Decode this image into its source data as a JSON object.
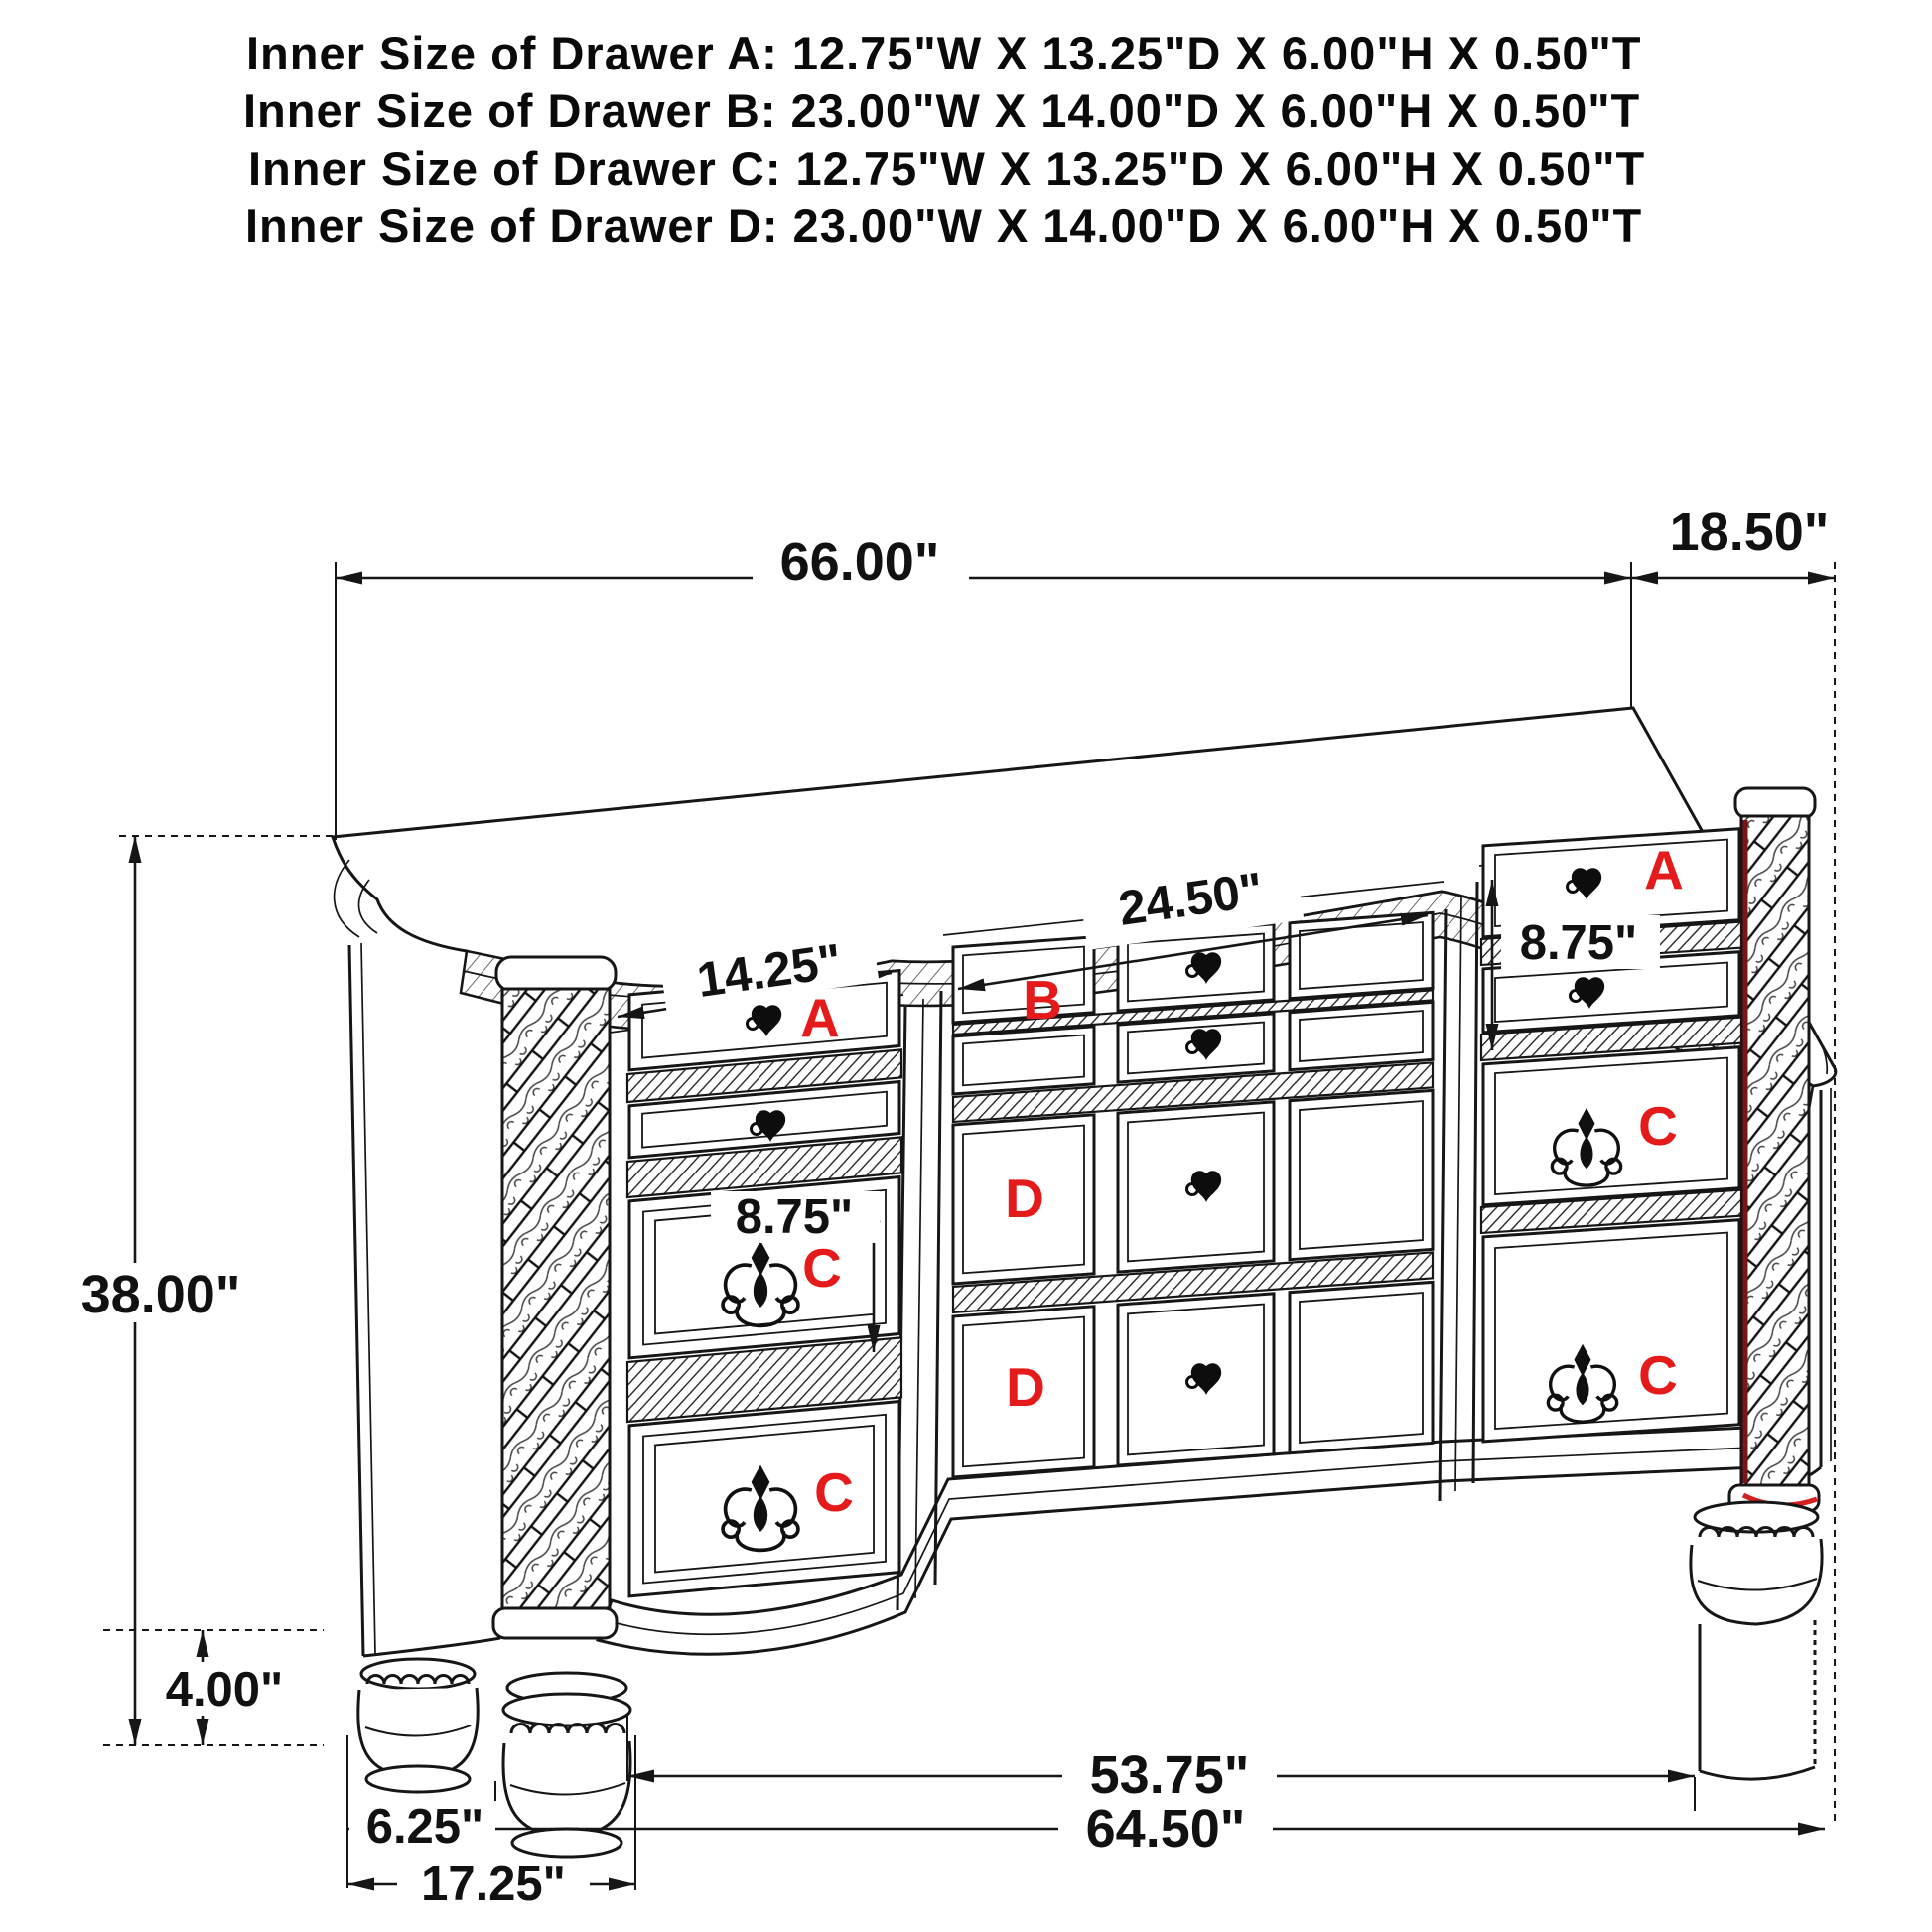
{
  "title_block": {
    "lines": [
      "Inner Size of Drawer A: 12.75\"W X 13.25\"D X 6.00\"H X 0.50\"T",
      "Inner Size of Drawer B: 23.00\"W X 14.00\"D X 6.00\"H X 0.50\"T",
      "Inner Size of Drawer C: 12.75\"W X 13.25\"D X 6.00\"H X 0.50\"T",
      "Inner Size of Drawer D: 23.00\"W X 14.00\"D X 6.00\"H X 0.50\"T"
    ]
  },
  "diagram": {
    "type": "furniture-dimension-line-drawing",
    "subject": "nine-drawer dresser, three-quarter perspective view",
    "dimensions": {
      "overall_width": "66.00\"",
      "overall_depth": "18.50\"",
      "overall_height": "38.00\"",
      "middle_drawer_width": "24.50\"",
      "left_drawer_width": "14.25\"",
      "left_drawer_height": "8.75\"",
      "right_drawer_height": "8.75\"",
      "foot_height": "4.00\"",
      "inner_feet_span": "53.75\"",
      "base_width": "64.50\"",
      "foot_inset": "6.25\"",
      "left_foot_span": "17.25\""
    },
    "drawer_labels": [
      {
        "id": "left-top",
        "text": "A"
      },
      {
        "id": "middle-top",
        "text": "B"
      },
      {
        "id": "right-top",
        "text": "A"
      },
      {
        "id": "left-middle",
        "text": "C"
      },
      {
        "id": "left-bottom",
        "text": "C"
      },
      {
        "id": "right-middle",
        "text": "C"
      },
      {
        "id": "right-bottom",
        "text": "C"
      },
      {
        "id": "middle-upper",
        "text": "D"
      },
      {
        "id": "middle-lower",
        "text": "D"
      }
    ],
    "colors": {
      "label_red": "#e51a1a",
      "line_color": "#161616",
      "accent_dark_red": "#7d1416",
      "accent_red": "#d42020"
    }
  }
}
